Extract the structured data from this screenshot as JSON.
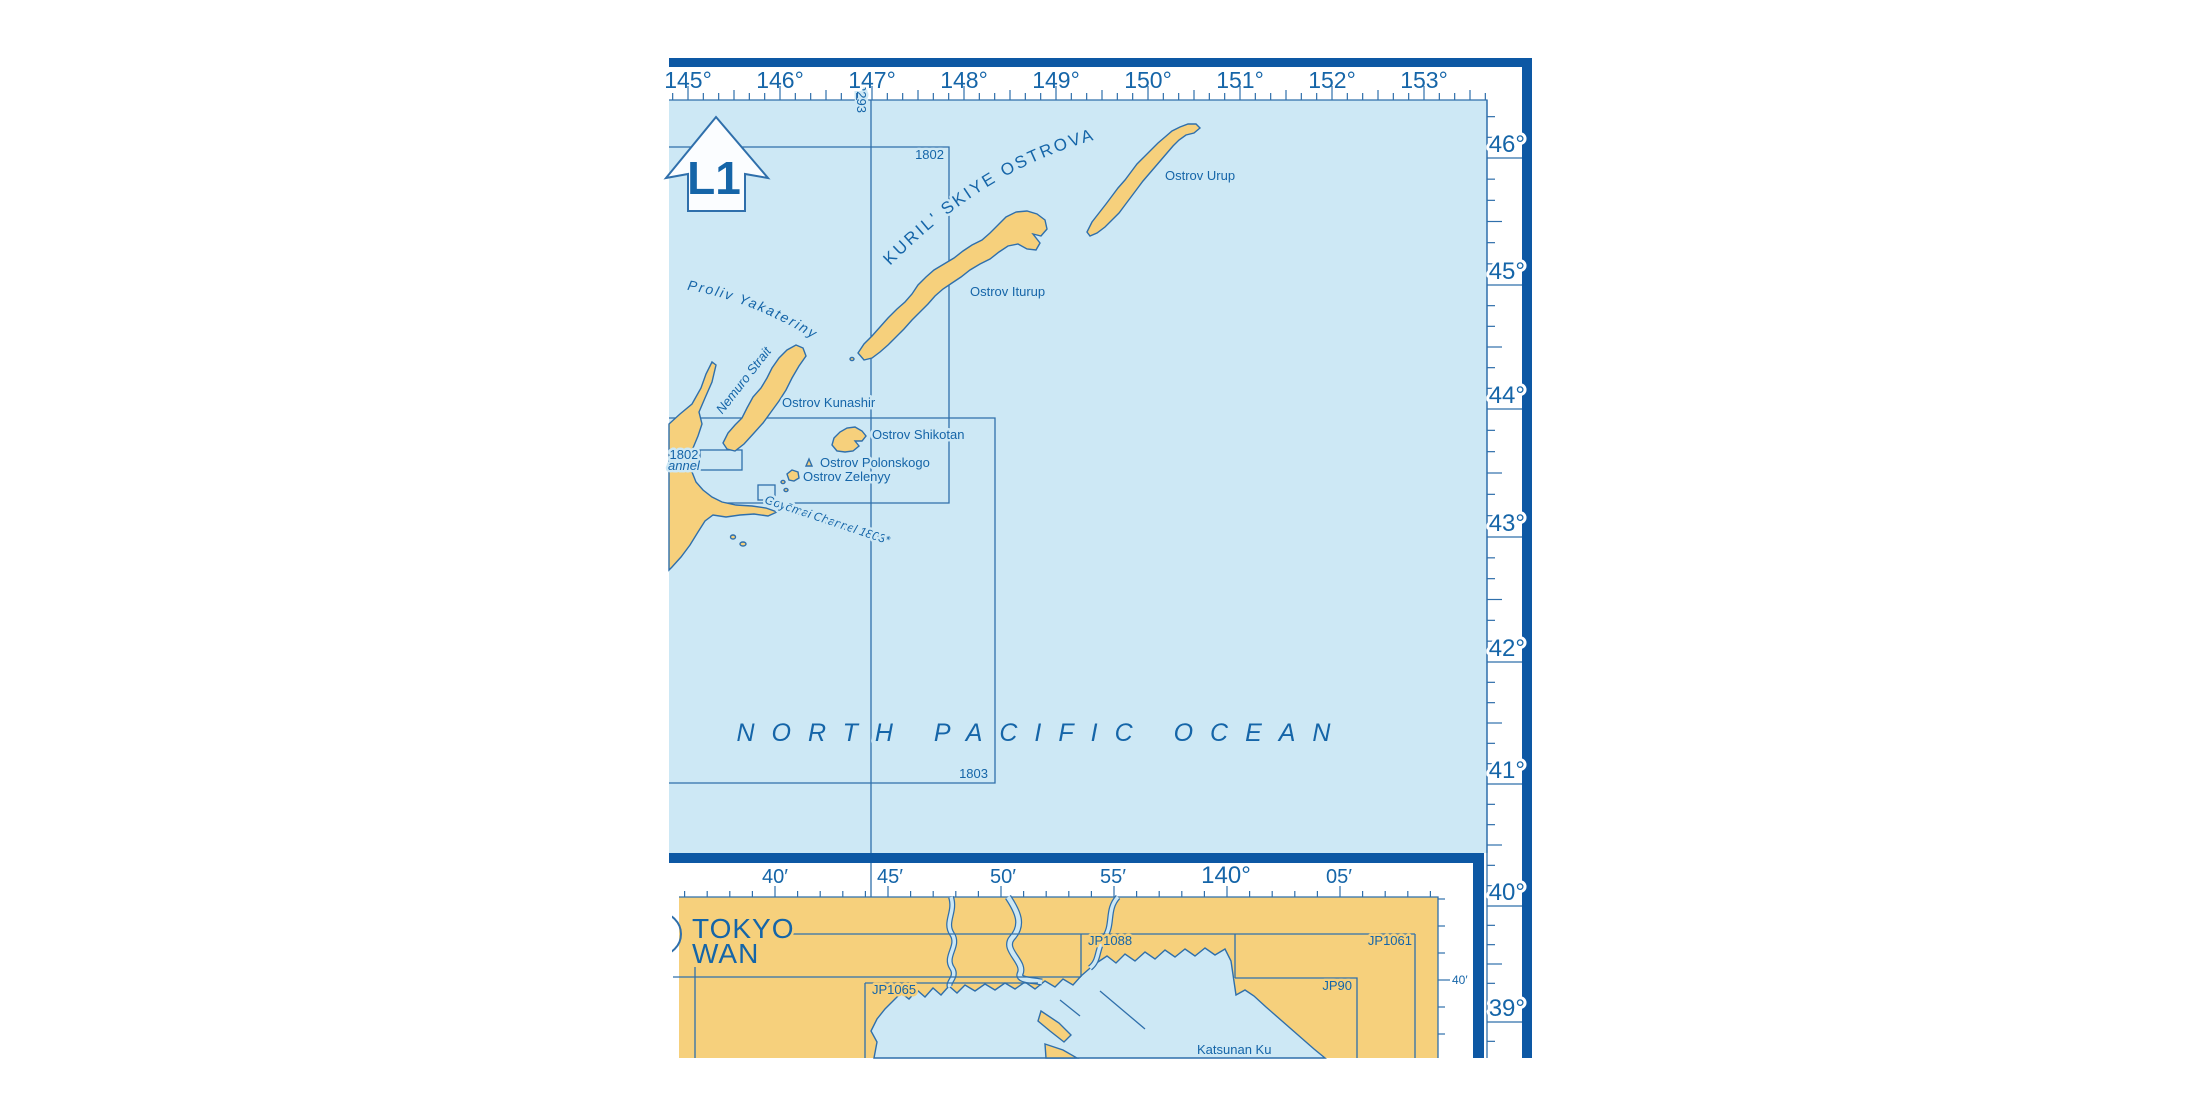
{
  "colors": {
    "sea": "#cde8f5",
    "land": "#f6d07c",
    "border": "#0d58a4",
    "line": "#2f6fab",
    "text": "#1565a8"
  },
  "main_map": {
    "top_ruler": {
      "labels": [
        "145°",
        "146°",
        "147°",
        "148°",
        "149°",
        "150°",
        "151°",
        "152°",
        "153°"
      ]
    },
    "right_ruler": {
      "labels": [
        "46°",
        "45°",
        "44°",
        "43°",
        "42°",
        "41°",
        "40°",
        "39°"
      ]
    },
    "arrow_label": "L1",
    "chart_refs": {
      "meridian": "2293",
      "box_a": "1802",
      "box_a_small": "1802",
      "box_b": "1803"
    },
    "labels": {
      "kuril_chain": "KURIL' SKIYE OSTROVA",
      "proliv": "Proliv Yakateriny",
      "nemuro": "Nemuro Strait",
      "urup": "Ostrov Urup",
      "iturup": "Ostrov Iturup",
      "kunashir": "Ostrov Kunashir",
      "shikotan": "Ostrov Shikotan",
      "polonskogo": "Ostrov Polonskogo",
      "zelenyy": "Ostrov Zelenyy",
      "channel_fragment": "annel",
      "goyomai": "Goyōmai Channel 1803*",
      "ocean": "NORTH PACIFIC OCEAN"
    }
  },
  "inset_map": {
    "title": [
      "TOKYO",
      "WAN"
    ],
    "top_ruler": {
      "labels": [
        "40′",
        "45′",
        "50′",
        "55′",
        "140°",
        "05′"
      ]
    },
    "right_ruler_label": "40′",
    "chart_boxes": {
      "jp1088": "JP1088",
      "jp1065": "JP1065",
      "jp1061": "JP1061",
      "jp90": "JP90"
    },
    "labels": {
      "katsunan": "Katsunan Ku"
    }
  }
}
